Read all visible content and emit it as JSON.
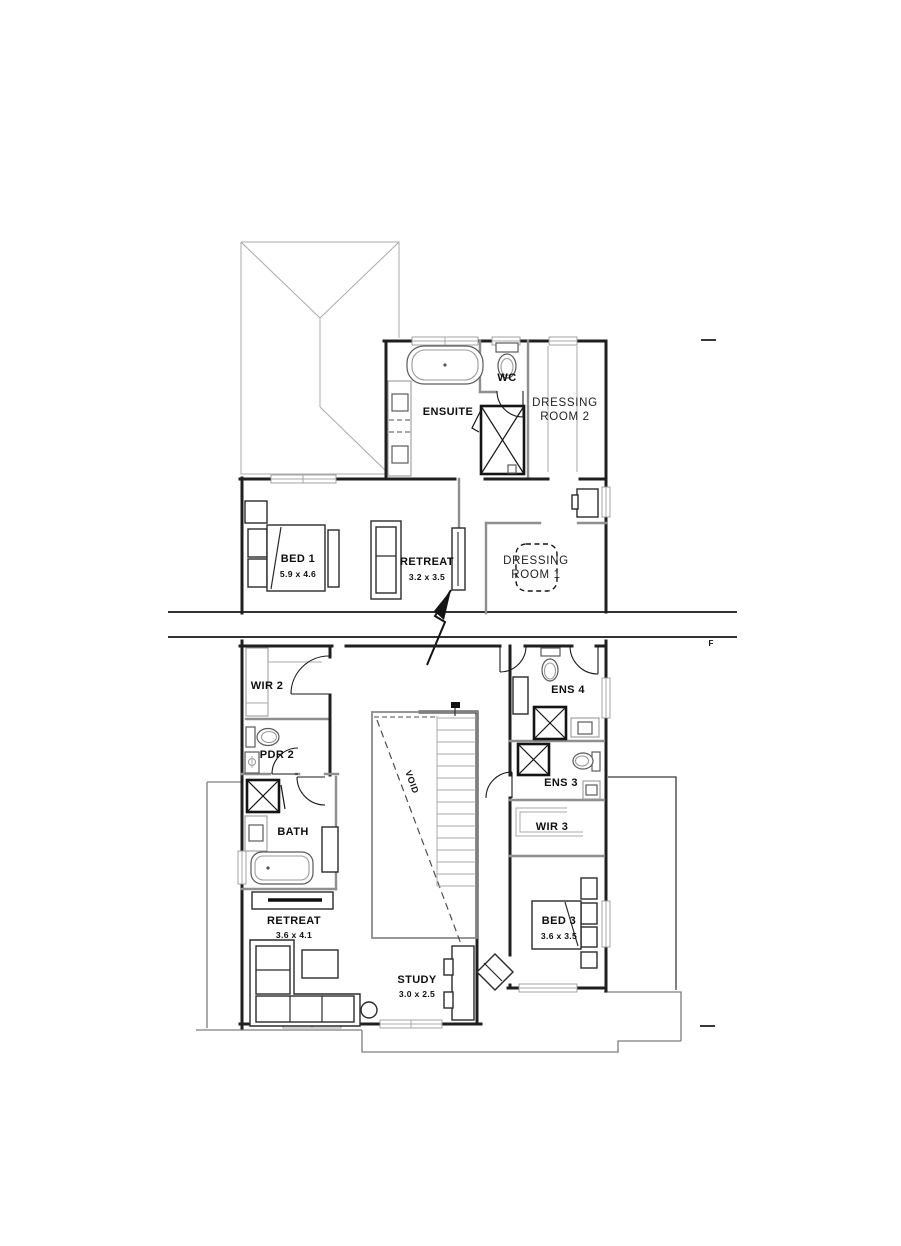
{
  "colors": {
    "wall": "#1f1f1f",
    "internal_wall": "#8f8f8f",
    "roof_line": "#ababab",
    "background": "#ffffff"
  },
  "rooms": [
    {
      "id": "ensuite",
      "label": "ENSUITE"
    },
    {
      "id": "wc",
      "label": "WC"
    },
    {
      "id": "dressing2",
      "label": "DRESSING",
      "label2": "ROOM 2"
    },
    {
      "id": "bed1",
      "label": "BED 1",
      "dims": "5.9 x 4.6"
    },
    {
      "id": "retreat-upper",
      "label": "RETREAT",
      "dims": "3.2 x 3.5"
    },
    {
      "id": "dressing1",
      "label": "DRESSING",
      "label2": "ROOM 1"
    },
    {
      "id": "wir2",
      "label": "WIR 2"
    },
    {
      "id": "pdr2",
      "label": "PDR 2"
    },
    {
      "id": "ens4",
      "label": "ENS 4"
    },
    {
      "id": "ens3",
      "label": "ENS 3"
    },
    {
      "id": "wir3",
      "label": "WIR 3"
    },
    {
      "id": "bath",
      "label": "BATH"
    },
    {
      "id": "retreat-lower",
      "label": "RETREAT",
      "dims": "3.6 x 4.1"
    },
    {
      "id": "bed3",
      "label": "BED 3",
      "dims": "3.6 x 3.5"
    },
    {
      "id": "study",
      "label": "STUDY",
      "dims": "3.0 x 2.5"
    },
    {
      "id": "void",
      "label": "VOID"
    }
  ],
  "annotations": {
    "break_marker": "F"
  },
  "symbols": [
    "bathtub",
    "freestanding-bath",
    "toilet",
    "shower",
    "vanity-basin",
    "double-bed",
    "bedside-table",
    "sofa",
    "l-shaped-sofa",
    "coffee-table",
    "side-table",
    "desk",
    "desk-chair",
    "stairs",
    "door-swing",
    "wardrobe-shelving",
    "ottoman",
    "tv-cabinet",
    "break-line",
    "hip-roof-outline"
  ]
}
